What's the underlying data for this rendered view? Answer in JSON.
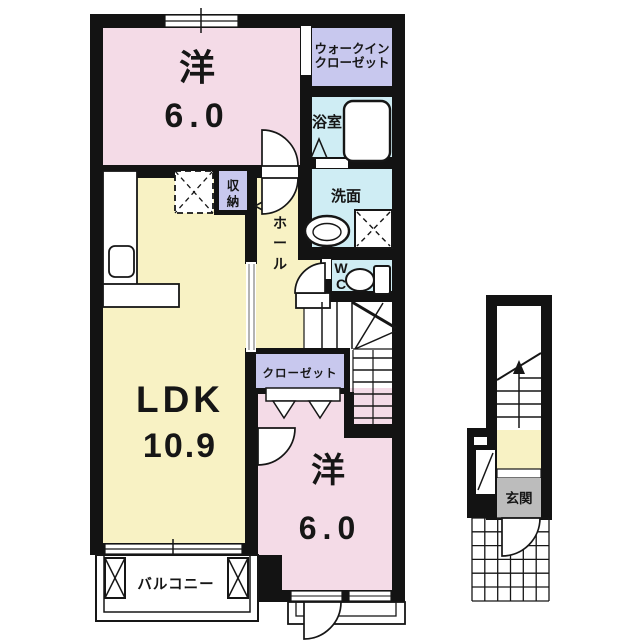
{
  "floor_plan": {
    "rooms": {
      "bedroom_top": {
        "label": "洋",
        "size": "6.0"
      },
      "walk_in_closet": {
        "line1": "ウォークイン",
        "line2": "クローゼット"
      },
      "bathroom": {
        "label": "浴室"
      },
      "washroom": {
        "label": "洗面"
      },
      "toilet": {
        "line1": "W",
        "line2": "C"
      },
      "hall": {
        "char1": "ホ",
        "char2": "ー",
        "char3": "ル"
      },
      "storage": {
        "char1": "収",
        "char2": "納"
      },
      "ldk": {
        "label": "LDK",
        "size": "10.9"
      },
      "closet": {
        "label": "クローゼット"
      },
      "bedroom_bottom": {
        "label": "洋",
        "size": "6.0"
      },
      "balcony": {
        "label": "バルコニー"
      },
      "entrance": {
        "label": "玄関"
      }
    },
    "colors": {
      "wall": "#131313",
      "bedroom_pink": "#f4dbe7",
      "ldk_yellow": "#f8f2c4",
      "closet_purple": "#c8c8ee",
      "wet_area_cyan": "#cfedf4",
      "entrance_gray": "#bcbcbc"
    }
  }
}
